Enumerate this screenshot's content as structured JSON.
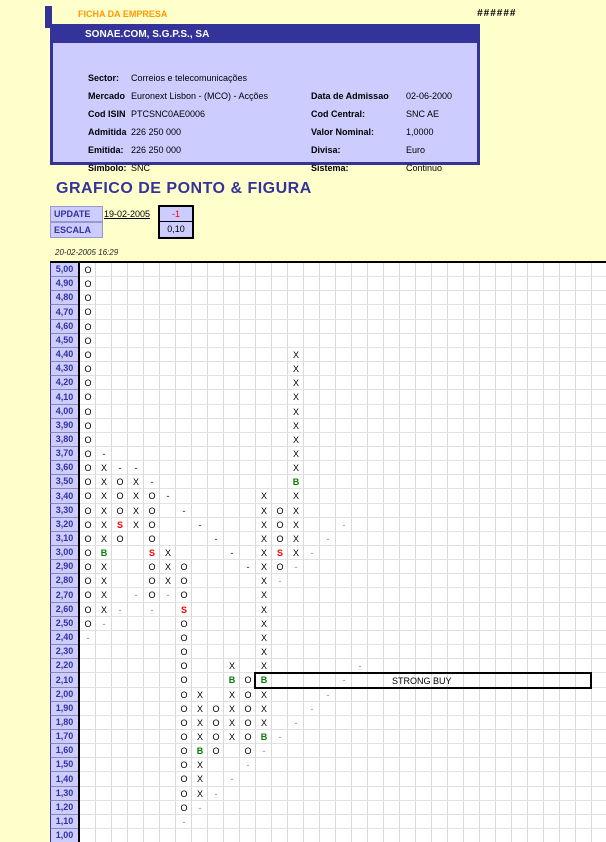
{
  "header": {
    "corner_label": "FICHA DA EMPRESA",
    "overflow_hashes": "######"
  },
  "company": {
    "title": "SONAE.COM, S.G.P.S., SA",
    "rows": [
      {
        "label": "Sector:",
        "value": "Correios e telecomunicações",
        "label2": "",
        "value2": ""
      },
      {
        "label": "Mercado",
        "value": "Euronext Lisbon - (MCO) - Acções",
        "label2": "Data de Admissao",
        "value2": "02-06-2000"
      },
      {
        "label": "Cod ISIN",
        "value": "PTCSNC0AE0006",
        "label2": "Cod Central:",
        "value2": "SNC AE"
      },
      {
        "label": "Admitida",
        "value": "226 250 000",
        "label2": "Valor Nominal:",
        "value2": "1,0000"
      },
      {
        "label": "Emitida:",
        "value": "226 250 000",
        "label2": "Divisa:",
        "value2": "Euro"
      },
      {
        "label": "Simbolo:",
        "value": "SNC",
        "label2": "Sistema:",
        "value2": "Continuo"
      }
    ]
  },
  "section_title": "GRAFICO DE PONTO & FIGURA",
  "update": {
    "label": "UPDATE",
    "date": "19-02-2005",
    "box_value": "-1"
  },
  "escala": {
    "label": "ESCALA",
    "box_value": "0,10"
  },
  "timestamp": "20-02-2005 16:29",
  "colors": {
    "navy": "#333399",
    "lavender": "#CCCCFF",
    "orange": "#FF9900",
    "signal_buy": "#008000",
    "signal_sell": "#FF0000",
    "trend_down_dash": "#606060",
    "trend_up_dash": "#f09090",
    "trend_gray_dash": "#a8a8a8",
    "page_bg": "#FFFFCC"
  },
  "chart_data": {
    "type": "point-and-figure",
    "title": "GRAFICO DE PONTO & FIGURA",
    "box_size": "0,10",
    "y_axis": {
      "max": "5,00",
      "min": "1,00",
      "step": "0,10"
    },
    "ylabels": [
      "5,00",
      "4,90",
      "4,80",
      "4,70",
      "4,60",
      "4,50",
      "4,40",
      "4,30",
      "4,20",
      "4,10",
      "4,00",
      "3,90",
      "3,80",
      "3,70",
      "3,60",
      "3,50",
      "3,40",
      "3,30",
      "3,20",
      "3,10",
      "3,00",
      "2,90",
      "2,80",
      "2,70",
      "2,60",
      "2,50",
      "2,40",
      "2,30",
      "2,20",
      "2,10",
      "2,00",
      "1,90",
      "1,80",
      "1,70",
      "1,60",
      "1,50",
      "1,40",
      "1,30",
      "1,20",
      "1,10",
      "1,00"
    ],
    "annotation": {
      "text": "STRONG BUY",
      "price": "2,10",
      "from_col": 12,
      "to_col": 32
    },
    "symbol_legend": {
      "O": "O",
      "X": "X",
      "B": "B",
      "S": "S",
      "-d": "-",
      "-g": "-",
      "-p": "-"
    },
    "symbols": [
      [
        "5,00",
        1,
        "O"
      ],
      [
        "4,90",
        1,
        "O"
      ],
      [
        "4,80",
        1,
        "O"
      ],
      [
        "4,70",
        1,
        "O"
      ],
      [
        "4,60",
        1,
        "O"
      ],
      [
        "4,50",
        1,
        "O"
      ],
      [
        "4,40",
        1,
        "O"
      ],
      [
        "4,30",
        1,
        "O"
      ],
      [
        "4,20",
        1,
        "O"
      ],
      [
        "4,10",
        1,
        "O"
      ],
      [
        "4,00",
        1,
        "O"
      ],
      [
        "3,90",
        1,
        "O"
      ],
      [
        "3,80",
        1,
        "O"
      ],
      [
        "3,70",
        1,
        "O"
      ],
      [
        "3,60",
        1,
        "O"
      ],
      [
        "3,50",
        1,
        "O"
      ],
      [
        "3,40",
        1,
        "O"
      ],
      [
        "3,30",
        1,
        "O"
      ],
      [
        "3,20",
        1,
        "O"
      ],
      [
        "3,10",
        1,
        "O"
      ],
      [
        "3,00",
        1,
        "O"
      ],
      [
        "2,90",
        1,
        "O"
      ],
      [
        "2,80",
        1,
        "O"
      ],
      [
        "2,70",
        1,
        "O"
      ],
      [
        "2,60",
        1,
        "O"
      ],
      [
        "2,50",
        1,
        "O"
      ],
      [
        "2,40",
        1,
        "-g"
      ],
      [
        "3,70",
        2,
        "-d"
      ],
      [
        "3,60",
        2,
        "X"
      ],
      [
        "3,50",
        2,
        "X"
      ],
      [
        "3,40",
        2,
        "X"
      ],
      [
        "3,30",
        2,
        "X"
      ],
      [
        "3,20",
        2,
        "X"
      ],
      [
        "3,10",
        2,
        "X"
      ],
      [
        "3,00",
        2,
        "B"
      ],
      [
        "2,90",
        2,
        "X"
      ],
      [
        "2,80",
        2,
        "X"
      ],
      [
        "2,70",
        2,
        "X"
      ],
      [
        "2,60",
        2,
        "X"
      ],
      [
        "2,50",
        2,
        "-g"
      ],
      [
        "3,60",
        3,
        "-d"
      ],
      [
        "3,50",
        3,
        "O"
      ],
      [
        "3,40",
        3,
        "O"
      ],
      [
        "3,30",
        3,
        "O"
      ],
      [
        "3,20",
        3,
        "S"
      ],
      [
        "3,10",
        3,
        "O"
      ],
      [
        "2,60",
        3,
        "-g"
      ],
      [
        "3,60",
        4,
        "-d"
      ],
      [
        "3,50",
        4,
        "X"
      ],
      [
        "3,40",
        4,
        "X"
      ],
      [
        "3,30",
        4,
        "X"
      ],
      [
        "3,20",
        4,
        "X"
      ],
      [
        "2,70",
        4,
        "-g"
      ],
      [
        "3,50",
        5,
        "-d"
      ],
      [
        "3,40",
        5,
        "O"
      ],
      [
        "3,30",
        5,
        "O"
      ],
      [
        "3,20",
        5,
        "O"
      ],
      [
        "3,10",
        5,
        "O"
      ],
      [
        "3,00",
        5,
        "S"
      ],
      [
        "2,90",
        5,
        "O"
      ],
      [
        "2,80",
        5,
        "O"
      ],
      [
        "2,70",
        5,
        "O"
      ],
      [
        "2,60",
        5,
        "-p"
      ],
      [
        "3,40",
        6,
        "-d"
      ],
      [
        "3,00",
        6,
        "X"
      ],
      [
        "2,90",
        6,
        "X"
      ],
      [
        "2,80",
        6,
        "X"
      ],
      [
        "2,70",
        6,
        "-p"
      ],
      [
        "3,30",
        7,
        "-d"
      ],
      [
        "2,90",
        7,
        "O"
      ],
      [
        "2,80",
        7,
        "O"
      ],
      [
        "2,70",
        7,
        "O"
      ],
      [
        "2,60",
        7,
        "S"
      ],
      [
        "2,50",
        7,
        "O"
      ],
      [
        "2,40",
        7,
        "O"
      ],
      [
        "2,30",
        7,
        "O"
      ],
      [
        "2,20",
        7,
        "O"
      ],
      [
        "2,10",
        7,
        "O"
      ],
      [
        "2,00",
        7,
        "O"
      ],
      [
        "1,90",
        7,
        "O"
      ],
      [
        "1,80",
        7,
        "O"
      ],
      [
        "1,70",
        7,
        "O"
      ],
      [
        "1,60",
        7,
        "O"
      ],
      [
        "1,50",
        7,
        "O"
      ],
      [
        "1,40",
        7,
        "O"
      ],
      [
        "1,30",
        7,
        "O"
      ],
      [
        "1,20",
        7,
        "O"
      ],
      [
        "1,10",
        7,
        "-p"
      ],
      [
        "3,20",
        8,
        "-d"
      ],
      [
        "2,00",
        8,
        "X"
      ],
      [
        "1,90",
        8,
        "X"
      ],
      [
        "1,80",
        8,
        "X"
      ],
      [
        "1,70",
        8,
        "X"
      ],
      [
        "1,60",
        8,
        "B"
      ],
      [
        "1,50",
        8,
        "X"
      ],
      [
        "1,40",
        8,
        "X"
      ],
      [
        "1,30",
        8,
        "X"
      ],
      [
        "1,20",
        8,
        "-p"
      ],
      [
        "3,10",
        9,
        "-d"
      ],
      [
        "1,90",
        9,
        "O"
      ],
      [
        "1,80",
        9,
        "O"
      ],
      [
        "1,70",
        9,
        "O"
      ],
      [
        "1,60",
        9,
        "O"
      ],
      [
        "1,30",
        9,
        "-p"
      ],
      [
        "3,00",
        10,
        "-d"
      ],
      [
        "2,20",
        10,
        "X"
      ],
      [
        "2,10",
        10,
        "B"
      ],
      [
        "2,00",
        10,
        "X"
      ],
      [
        "1,90",
        10,
        "X"
      ],
      [
        "1,80",
        10,
        "X"
      ],
      [
        "1,70",
        10,
        "X"
      ],
      [
        "1,40",
        10,
        "-p"
      ],
      [
        "2,90",
        11,
        "-d"
      ],
      [
        "2,10",
        11,
        "O"
      ],
      [
        "2,00",
        11,
        "O"
      ],
      [
        "1,90",
        11,
        "O"
      ],
      [
        "1,80",
        11,
        "O"
      ],
      [
        "1,70",
        11,
        "O"
      ],
      [
        "1,60",
        11,
        "O"
      ],
      [
        "1,50",
        11,
        "-p"
      ],
      [
        "3,40",
        12,
        "X"
      ],
      [
        "3,30",
        12,
        "X"
      ],
      [
        "3,20",
        12,
        "X"
      ],
      [
        "3,10",
        12,
        "X"
      ],
      [
        "3,00",
        12,
        "X"
      ],
      [
        "2,90",
        12,
        "X"
      ],
      [
        "2,80",
        12,
        "X"
      ],
      [
        "2,70",
        12,
        "X"
      ],
      [
        "2,60",
        12,
        "X"
      ],
      [
        "2,50",
        12,
        "X"
      ],
      [
        "2,40",
        12,
        "X"
      ],
      [
        "2,30",
        12,
        "X"
      ],
      [
        "2,20",
        12,
        "X"
      ],
      [
        "2,10",
        12,
        "B"
      ],
      [
        "2,00",
        12,
        "X"
      ],
      [
        "1,90",
        12,
        "X"
      ],
      [
        "1,80",
        12,
        "X"
      ],
      [
        "1,70",
        12,
        "B"
      ],
      [
        "1,60",
        12,
        "-p"
      ],
      [
        "3,30",
        13,
        "O"
      ],
      [
        "3,20",
        13,
        "O"
      ],
      [
        "3,10",
        13,
        "O"
      ],
      [
        "3,00",
        13,
        "S"
      ],
      [
        "2,90",
        13,
        "O"
      ],
      [
        "2,80",
        13,
        "-p"
      ],
      [
        "1,70",
        13,
        "-p"
      ],
      [
        "4,40",
        14,
        "X"
      ],
      [
        "4,30",
        14,
        "X"
      ],
      [
        "4,20",
        14,
        "X"
      ],
      [
        "4,10",
        14,
        "X"
      ],
      [
        "4,00",
        14,
        "X"
      ],
      [
        "3,90",
        14,
        "X"
      ],
      [
        "3,80",
        14,
        "X"
      ],
      [
        "3,70",
        14,
        "X"
      ],
      [
        "3,60",
        14,
        "X"
      ],
      [
        "3,50",
        14,
        "B"
      ],
      [
        "3,40",
        14,
        "X"
      ],
      [
        "3,30",
        14,
        "X"
      ],
      [
        "3,20",
        14,
        "X"
      ],
      [
        "3,10",
        14,
        "X"
      ],
      [
        "3,00",
        14,
        "X"
      ],
      [
        "2,90",
        14,
        "-p"
      ],
      [
        "1,80",
        14,
        "-p"
      ],
      [
        "3,00",
        15,
        "-p"
      ],
      [
        "1,90",
        15,
        "-p"
      ],
      [
        "3,10",
        16,
        "-p"
      ],
      [
        "2,00",
        16,
        "-p"
      ],
      [
        "3,20",
        17,
        "-p"
      ],
      [
        "2,10",
        17,
        "-p"
      ],
      [
        "2,20",
        18,
        "-p"
      ]
    ]
  }
}
